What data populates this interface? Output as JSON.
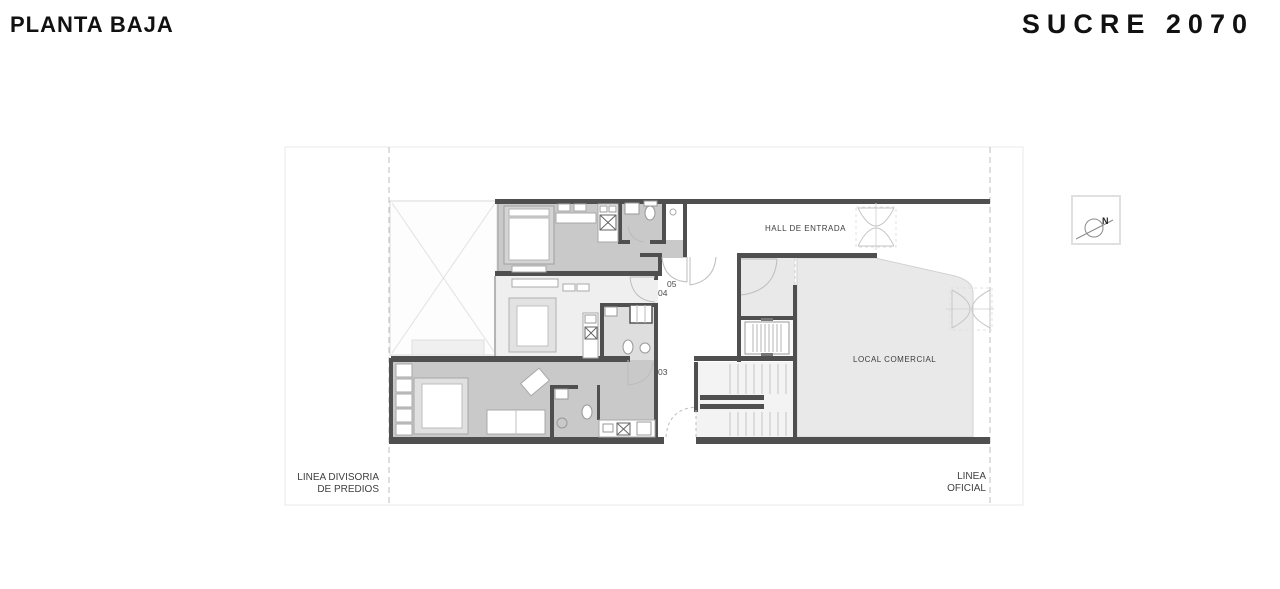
{
  "header": {
    "plan_title": "PLANTA BAJA",
    "project_title": "SUCRE 2070"
  },
  "plan": {
    "rooms": {
      "hall": "HALL DE ENTRADA",
      "local_comercial": "LOCAL COMERCIAL"
    },
    "units": [
      {
        "number": "05"
      },
      {
        "number": "04"
      },
      {
        "number": "03"
      }
    ],
    "boundaries": {
      "left_line1": "LINEA DIVISORIA",
      "left_line2": "DE PREDIOS",
      "right_line1": "LINEA",
      "right_line2": "OFICIAL"
    },
    "compass": {
      "north_label": "N"
    },
    "colors": {
      "wall": "#4f4f4f",
      "unit_dark_fill": "#c9c9c9",
      "unit_light_fill": "#efefef",
      "commercial_fill": "#e9e9e9",
      "guide_line": "#bdbdbd",
      "title_text": "#111111",
      "label_text": "#3d3d3d"
    }
  }
}
